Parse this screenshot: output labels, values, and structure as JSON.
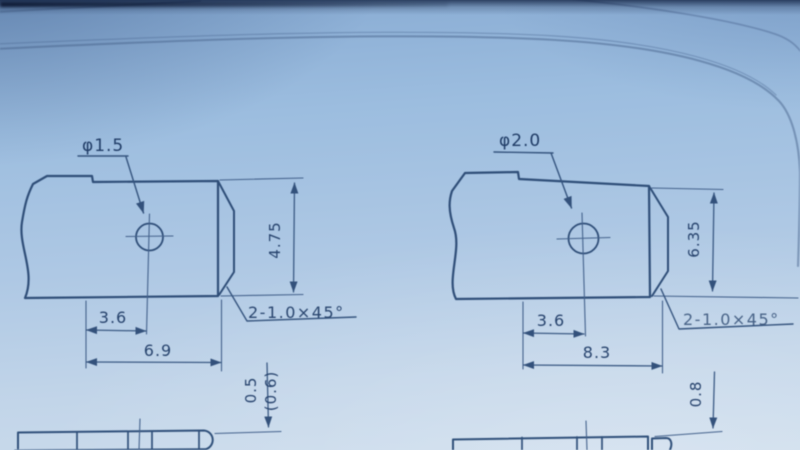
{
  "meta": {
    "kind": "photograph of engineering drawing (two chamfered tab terminals with holes)",
    "paper_color": "#a9c6e3",
    "line_color": "#2f4e78",
    "text_color": "#27436d"
  },
  "drawings": [
    {
      "id": "left-part",
      "hole_diameter_label": "φ1.5",
      "height_dim": "4.75",
      "hole_offset_dim": "3.6",
      "length_dim": "6.9",
      "chamfer_label": "2-1.0×45°",
      "thickness_dim": "0.5",
      "thickness_ref_dim": "(0.6)"
    },
    {
      "id": "right-part",
      "hole_diameter_label": "φ2.0",
      "height_dim": "6.35",
      "hole_offset_dim": "3.6",
      "length_dim": "8.3",
      "chamfer_label": "2-1.0×45°",
      "thickness_dim": "0.8"
    }
  ]
}
